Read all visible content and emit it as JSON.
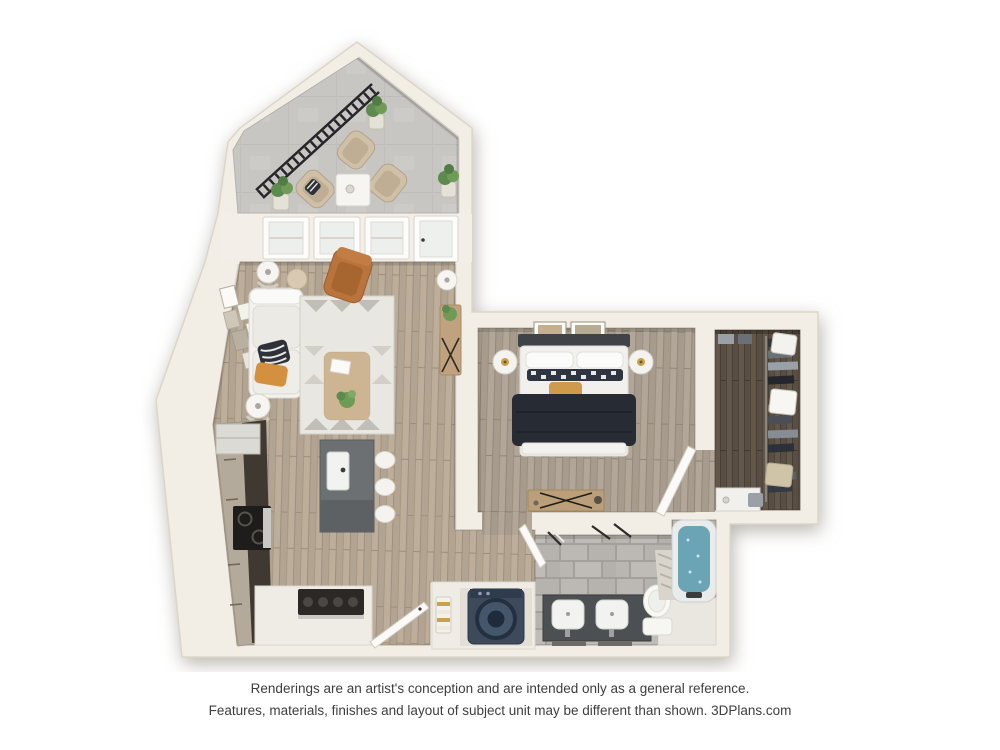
{
  "disclaimer": {
    "line1": "Renderings are an artist's conception and are intended only as a general reference.",
    "line2": "Features, materials, finishes and layout of subject unit may be different than shown. 3DPlans.com"
  },
  "floorplan": {
    "view": "3d-top-down-apartment-floor-plan-rendering",
    "rooms": [
      {
        "name": "balcony",
        "floor": "concrete",
        "items": [
          "black-railing",
          "lounge-chair",
          "lounge-chair",
          "lounge-chair",
          "side-table",
          "potted-plant",
          "potted-plant",
          "potted-plant"
        ]
      },
      {
        "name": "living-room",
        "floor": "light-wood-plank",
        "items": [
          "white-sectional-sofa",
          "zebra-pillow",
          "orange-pillow",
          "patterned-area-rug",
          "wood-coffee-table",
          "caramel-armchair",
          "floor-lamp",
          "floor-lamp",
          "floor-lamp",
          "gallery-wall-frames",
          "console-table",
          "windows",
          "balcony-door"
        ]
      },
      {
        "name": "kitchen",
        "floor": "light-wood-plank",
        "items": [
          "cabinet-run",
          "refrigerator",
          "black-cooktop",
          "gray-island-with-sink",
          "bar-stool",
          "bar-stool",
          "bar-stool",
          "gas-range-counter",
          "entry-door"
        ]
      },
      {
        "name": "bedroom",
        "floor": "gray-wood-plank",
        "items": [
          "bed-navy-comforter",
          "checkered-pillows",
          "orange-lumbar-pillow",
          "round-nightstand",
          "round-nightstand",
          "wall-art",
          "wall-art",
          "desk-with-x-legs",
          "door"
        ]
      },
      {
        "name": "walk-in-closet",
        "floor": "dark-wood-plank",
        "items": [
          "hanging-clothes",
          "shelf-boxes",
          "dresser"
        ]
      },
      {
        "name": "bathroom",
        "floor": "gray-stone-tile",
        "items": [
          "double-vanity",
          "sink",
          "sink",
          "toilet",
          "bathtub",
          "shower-curtain",
          "towel-bars",
          "door"
        ]
      },
      {
        "name": "laundry-closet",
        "floor": "white",
        "items": [
          "washer",
          "towel-ladder"
        ]
      }
    ],
    "colors": {
      "background": "#ffffff",
      "wall": "#f2eee6",
      "wood_light": "#b4a593",
      "wood_bedroom": "#a89c8e",
      "wood_dark": "#574d43",
      "concrete": "#c7c6c3",
      "tile": "#b7b3ae",
      "island": "#6d7073",
      "bed_comforter": "#262b34",
      "armchair": "#b8743c",
      "accent_orange": "#d3903f",
      "tub_water": "#6ba4b4",
      "washer": "#3c4a5c",
      "railing": "#26262a"
    }
  }
}
